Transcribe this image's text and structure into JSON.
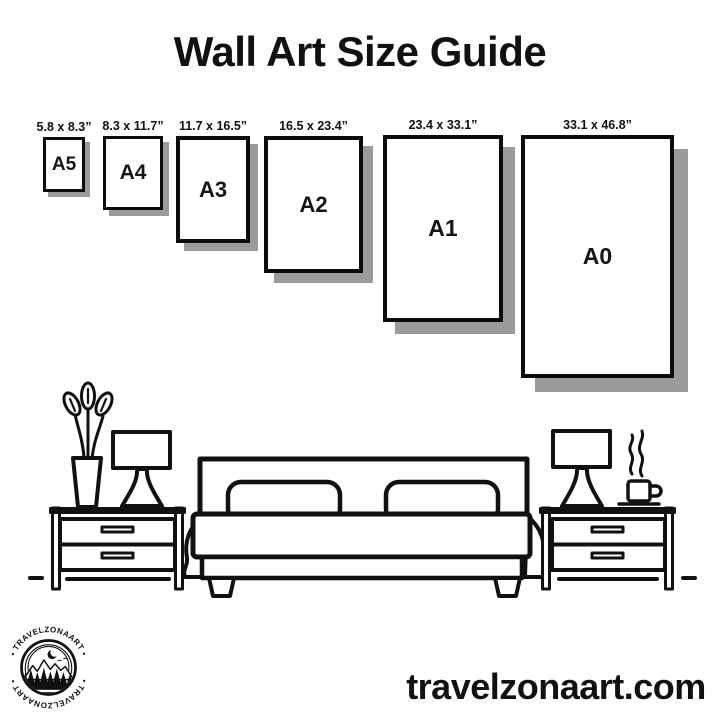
{
  "page": {
    "title": "Wall Art Size Guide",
    "website": "travelzonaart.com"
  },
  "colors": {
    "ink": "#111111",
    "paper": "#ffffff",
    "shadow": "#9b9b9b"
  },
  "size_guide": {
    "sizes": [
      {
        "code": "A5",
        "dimensions": "5.8 x 8.3”"
      },
      {
        "code": "A4",
        "dimensions": "8.3 x 11.7”"
      },
      {
        "code": "A3",
        "dimensions": "11.7 x 16.5”"
      },
      {
        "code": "A2",
        "dimensions": "16.5 x 23.4”"
      },
      {
        "code": "A1",
        "dimensions": "23.4 x 33.1”"
      },
      {
        "code": "A0",
        "dimensions": "33.1 x 46.8”"
      }
    ]
  },
  "logo": {
    "badge_text_top": "• TRAVELZONAART •",
    "badge_text_bottom": "• TRAVELZONAART •",
    "scene": "mountains-forest-moon"
  },
  "illustration": {
    "name": "bedroom-scene",
    "elements": [
      "bed",
      "headboard",
      "pillows",
      "nightstand-left",
      "nightstand-right",
      "table-lamp-left",
      "table-lamp-right",
      "vase-with-plant",
      "coffee-cup",
      "steam",
      "floor-line"
    ]
  }
}
